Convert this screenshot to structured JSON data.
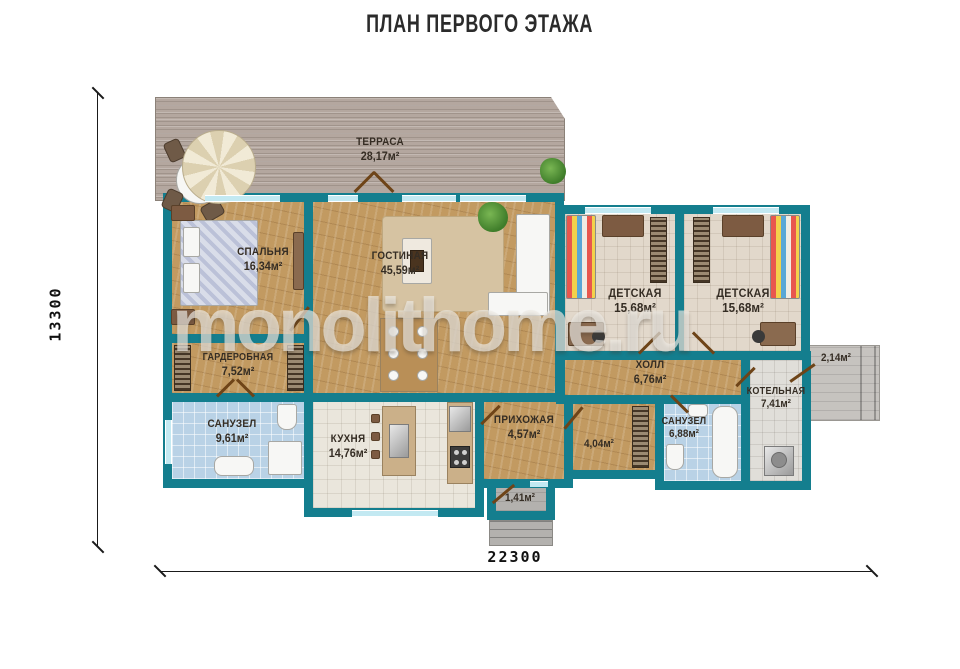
{
  "title": "ПЛАН ПЕРВОГО ЭТАЖА",
  "watermark": "monolithome.ru",
  "dimension_labels": {
    "height": "13300",
    "width": "22300"
  },
  "colors": {
    "wall": "#147e8e",
    "wood": "#c29a61",
    "deck": "#b4a79f",
    "tbeige": "#e2d8cb",
    "tblue": "#b9d2e6",
    "twhite": "#eae6dc",
    "tgray": "#e0ded9",
    "concrete": "#b3b1ae",
    "title": "#2b2b2b"
  },
  "rooms": [
    {
      "id": "terrace",
      "name": "ТЕРРАСА",
      "area": "28,17м²"
    },
    {
      "id": "bedroom",
      "name": "СПАЛЬНЯ",
      "area": "16,34м²"
    },
    {
      "id": "living",
      "name": "ГОСТИНАЯ",
      "area": "45,59м²"
    },
    {
      "id": "wardrobe",
      "name": "ГАРДЕРОБНАЯ",
      "area": "7,52м²"
    },
    {
      "id": "bath1",
      "name": "САНУЗЕЛ",
      "area": "9,61м²"
    },
    {
      "id": "kitchen",
      "name": "КУХНЯ",
      "area": "14,76м²"
    },
    {
      "id": "entry-hall",
      "name": "ПРИХОЖАЯ",
      "area": "4,57м²"
    },
    {
      "id": "closet",
      "name": "",
      "area": "4,04м²"
    },
    {
      "id": "bath2",
      "name": "САНУЗЕЛ",
      "area": "6,88м²"
    },
    {
      "id": "hall",
      "name": "ХОЛЛ",
      "area": "6,76м²"
    },
    {
      "id": "nursery1",
      "name": "ДЕТСКАЯ",
      "area": "15,68м²"
    },
    {
      "id": "nursery2",
      "name": "ДЕТСКАЯ",
      "area": "15,68м²"
    },
    {
      "id": "boiler",
      "name": "КОТЕЛЬНАЯ",
      "area": "7,41м²"
    },
    {
      "id": "side-porch",
      "name": "",
      "area": "2,14м²"
    },
    {
      "id": "vestibule",
      "name": "",
      "area": "1,41м²"
    }
  ]
}
